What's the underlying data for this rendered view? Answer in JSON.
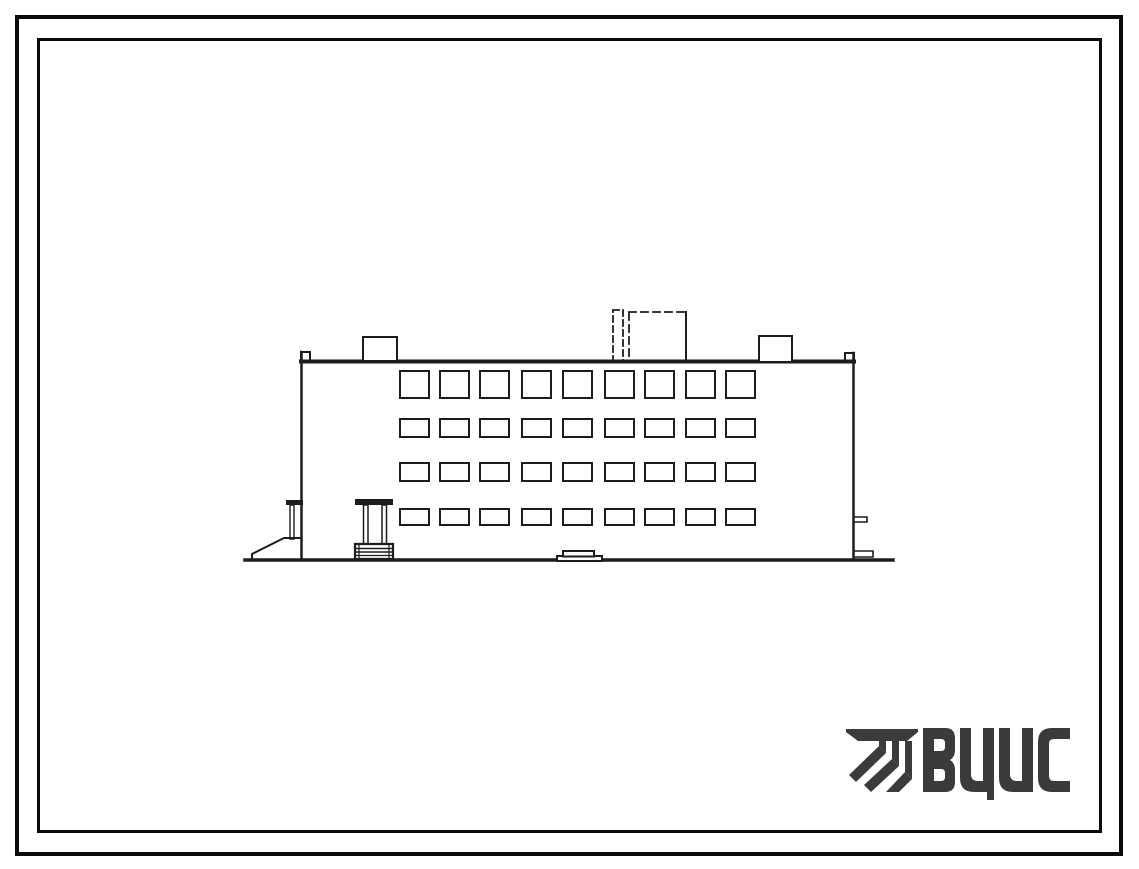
{
  "page": {
    "background_color": "#ffffff",
    "frame_color": "#0a0a0a",
    "frame_style": "double-border"
  },
  "drawing": {
    "type": "architectural-elevation",
    "subject": "four-storey building side elevation, hand-drawn line art",
    "ink_color": "#1d1d1d",
    "window_grid": {
      "columns": 9,
      "rows_count": 4,
      "column_xs": [
        400,
        440,
        480,
        522,
        563,
        605,
        645,
        686,
        726
      ],
      "window_width": 29,
      "rows": [
        {
          "y": 371,
          "height": 27
        },
        {
          "y": 419,
          "height": 18
        },
        {
          "y": 463,
          "height": 18
        },
        {
          "y": 509,
          "height": 16
        }
      ]
    },
    "features": [
      "parapet with raised end caps",
      "left rooftop box",
      "center rooftop penthouse (dashed outline)",
      "right rooftop box",
      "main entrance porch with canopy, two posts and steps",
      "left side entry with canopy, post and ramp",
      "central doorstep stoop",
      "ground line"
    ]
  },
  "logo": {
    "text": "ВЦИС",
    "color": "#3b3b3d",
    "icon": "hatched-monogram-icon"
  }
}
